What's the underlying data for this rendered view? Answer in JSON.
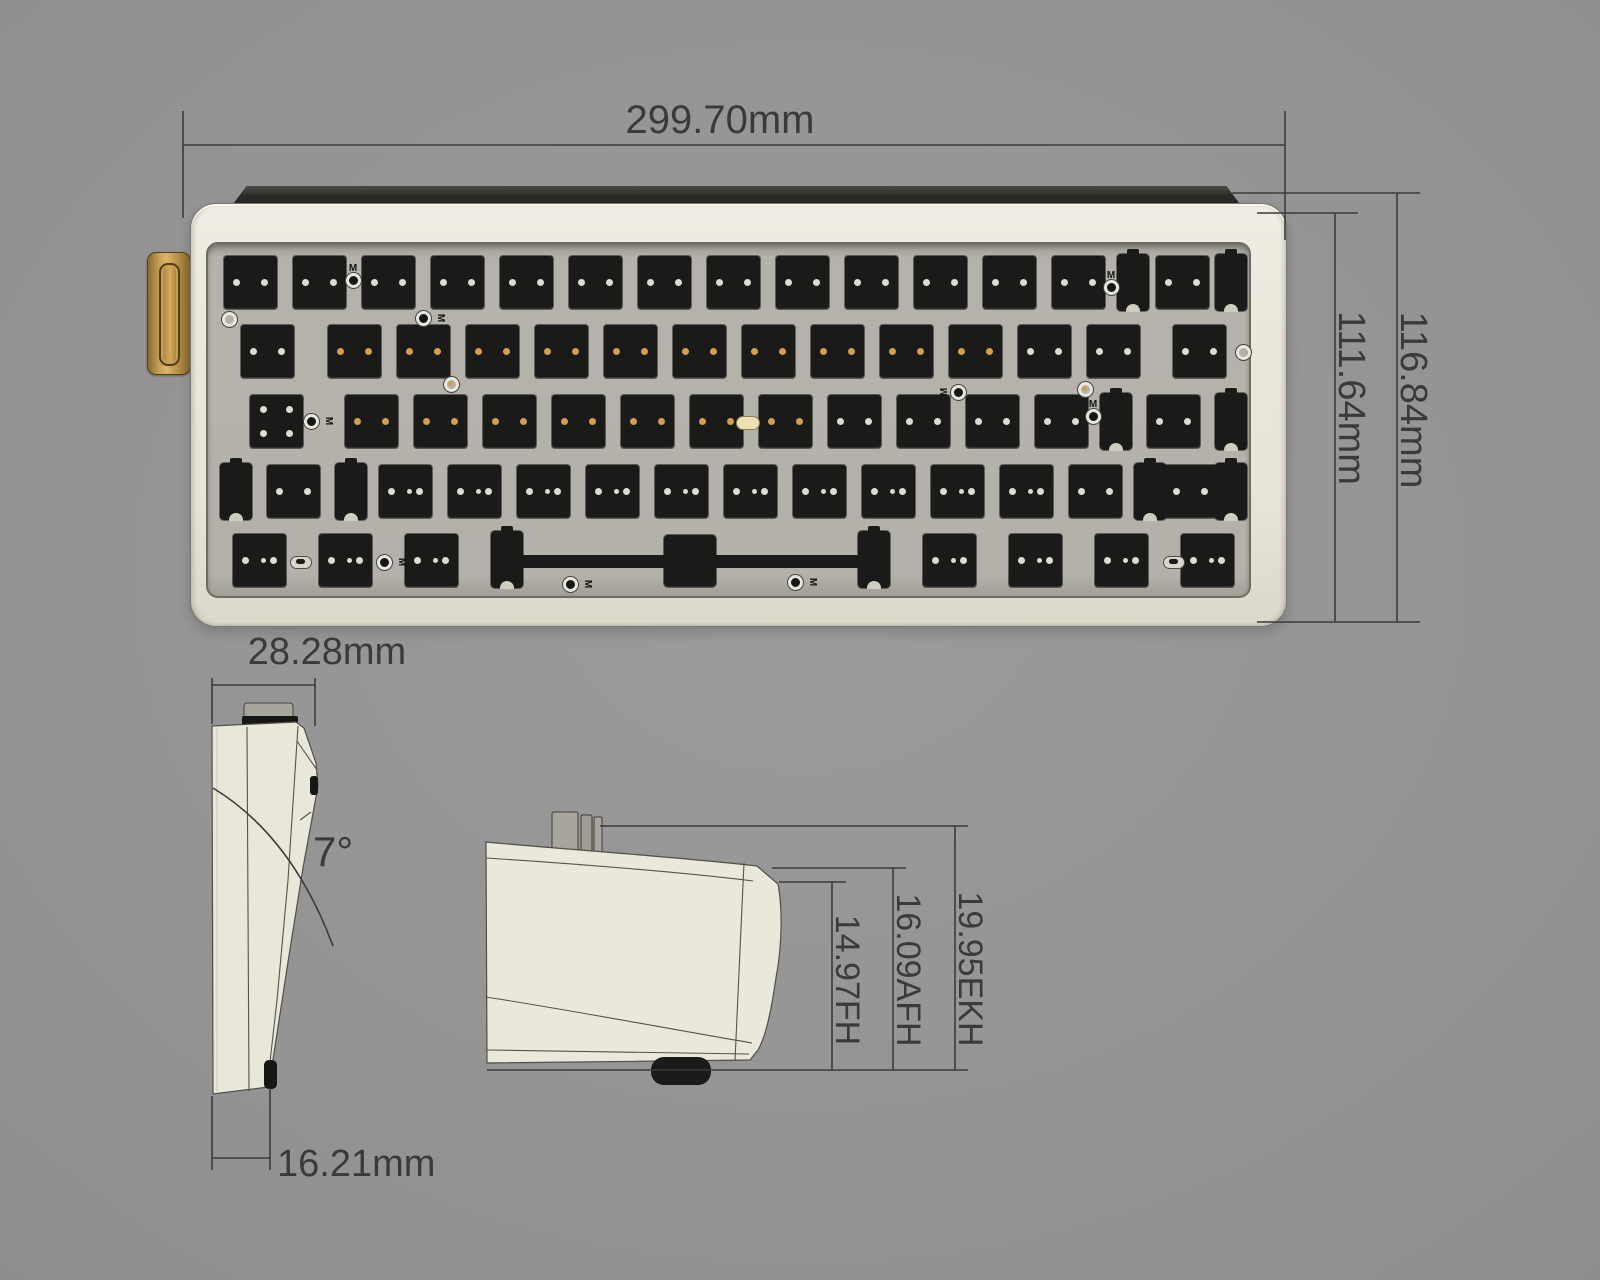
{
  "annotations": {
    "top_width": "299.70mm",
    "case_depth_inner": "111.64mm",
    "case_depth_outer": "116.84mm",
    "side_top_width": "28.28mm",
    "typing_angle": "7°",
    "side_front_width": "16.21mm",
    "front_height": "14.97FH",
    "mid_height": "16.09AFH",
    "back_height": "19.95EKH"
  },
  "colors": {
    "background_gray": "#939393",
    "case_cream": "#e9e6da",
    "plate_gray": "#b3b1a9",
    "pad_black": "#1a1a18",
    "accent_gold": "#c9a257",
    "dimension_ink": "#3a3a38"
  },
  "keyboard": {
    "unit_px": 69,
    "keys_left": 8,
    "pad_px": 53,
    "m_glyph": "M",
    "row_y": [
      12,
      81,
      151,
      221,
      290
    ],
    "rows": [
      {
        "keys": [
          {
            "w": 1,
            "d": "w"
          },
          {
            "w": 1,
            "d": "w"
          },
          {
            "w": 1,
            "d": "w"
          },
          {
            "w": 1,
            "d": "w"
          },
          {
            "w": 1,
            "d": "w"
          },
          {
            "w": 1,
            "d": "w"
          },
          {
            "w": 1,
            "d": "w"
          },
          {
            "w": 1,
            "d": "w"
          },
          {
            "w": 1,
            "d": "w"
          },
          {
            "w": 1,
            "d": "w"
          },
          {
            "w": 1,
            "d": "w"
          },
          {
            "w": 1,
            "d": "w"
          },
          {
            "w": 1,
            "d": "w"
          },
          {
            "w": 2,
            "s": true,
            "d": "w"
          }
        ]
      },
      {
        "keys": [
          {
            "w": 1.5,
            "d": "w"
          },
          {
            "w": 1,
            "d": "g"
          },
          {
            "w": 1,
            "d": "g"
          },
          {
            "w": 1,
            "d": "g"
          },
          {
            "w": 1,
            "d": "g"
          },
          {
            "w": 1,
            "d": "g"
          },
          {
            "w": 1,
            "d": "g"
          },
          {
            "w": 1,
            "d": "g"
          },
          {
            "w": 1,
            "d": "g"
          },
          {
            "w": 1,
            "d": "g"
          },
          {
            "w": 1,
            "d": "g"
          },
          {
            "w": 1,
            "d": "w"
          },
          {
            "w": 1,
            "d": "w"
          },
          {
            "w": 1.5,
            "d": "w"
          }
        ]
      },
      {
        "keys": [
          {
            "w": 1.75,
            "d": "q"
          },
          {
            "w": 1,
            "d": "g"
          },
          {
            "w": 1,
            "d": "g"
          },
          {
            "w": 1,
            "d": "g"
          },
          {
            "w": 1,
            "d": "g"
          },
          {
            "w": 1,
            "d": "g"
          },
          {
            "w": 1,
            "d": "g"
          },
          {
            "w": 1,
            "d": "g"
          },
          {
            "w": 1,
            "d": "w"
          },
          {
            "w": 1,
            "d": "w"
          },
          {
            "w": 1,
            "d": "w"
          },
          {
            "w": 1,
            "d": "w"
          },
          {
            "w": 2.25,
            "s": true,
            "d": "w"
          }
        ]
      },
      {
        "keys": [
          {
            "w": 2.25,
            "s": true,
            "d": "w"
          },
          {
            "w": 1,
            "d": "w",
            "d3": true
          },
          {
            "w": 1,
            "d": "w",
            "d3": true
          },
          {
            "w": 1,
            "d": "w",
            "d3": true
          },
          {
            "w": 1,
            "d": "w",
            "d3": true
          },
          {
            "w": 1,
            "d": "w",
            "d3": true
          },
          {
            "w": 1,
            "d": "w",
            "d3": true
          },
          {
            "w": 1,
            "d": "w",
            "d3": true
          },
          {
            "w": 1,
            "d": "w",
            "d3": true
          },
          {
            "w": 1,
            "d": "w",
            "d3": true
          },
          {
            "w": 1,
            "d": "w",
            "d3": true
          },
          {
            "w": 1,
            "d": "w"
          },
          {
            "w": 1.75,
            "s": true,
            "d": "w"
          }
        ]
      },
      {
        "keys": [
          {
            "w": 1.25,
            "d": "w",
            "d3": true
          },
          {
            "w": 1.25,
            "d": "w",
            "d3": true
          },
          {
            "w": 1.25,
            "d": "w",
            "d3": true
          },
          {
            "w": 6.25,
            "sp": true
          },
          {
            "w": 1.25,
            "d": "w",
            "d3": true
          },
          {
            "w": 1.25,
            "d": "w",
            "d3": true
          },
          {
            "w": 1.25,
            "d": "w",
            "d3": true
          },
          {
            "w": 1.25,
            "d": "w",
            "d3": true
          }
        ]
      }
    ],
    "markers": [
      {
        "x": 226,
        "y": 316,
        "t": "ring"
      },
      {
        "x": 1240,
        "y": 349,
        "t": "ring"
      },
      {
        "x": 350,
        "y": 277,
        "t": "dot",
        "m": "up"
      },
      {
        "x": 420,
        "y": 315,
        "t": "dot",
        "m": "right"
      },
      {
        "x": 448,
        "y": 381,
        "t": "ring",
        "c": "gold"
      },
      {
        "x": 1082,
        "y": 386,
        "t": "ring",
        "c": "gold"
      },
      {
        "x": 308,
        "y": 418,
        "t": "dot",
        "m": "right"
      },
      {
        "x": 955,
        "y": 389,
        "t": "dot",
        "m": "left"
      },
      {
        "x": 1108,
        "y": 284,
        "t": "dot",
        "m": "up"
      },
      {
        "x": 1090,
        "y": 413,
        "t": "dot",
        "m": "up"
      },
      {
        "x": 745,
        "y": 420,
        "t": "led"
      },
      {
        "x": 298,
        "y": 559,
        "t": "oval"
      },
      {
        "x": 1171,
        "y": 559,
        "t": "oval"
      },
      {
        "x": 381,
        "y": 559,
        "t": "dot",
        "m": "right"
      },
      {
        "x": 567,
        "y": 581,
        "t": "dot",
        "m": "right"
      },
      {
        "x": 792,
        "y": 579,
        "t": "dot",
        "m": "right"
      }
    ]
  }
}
